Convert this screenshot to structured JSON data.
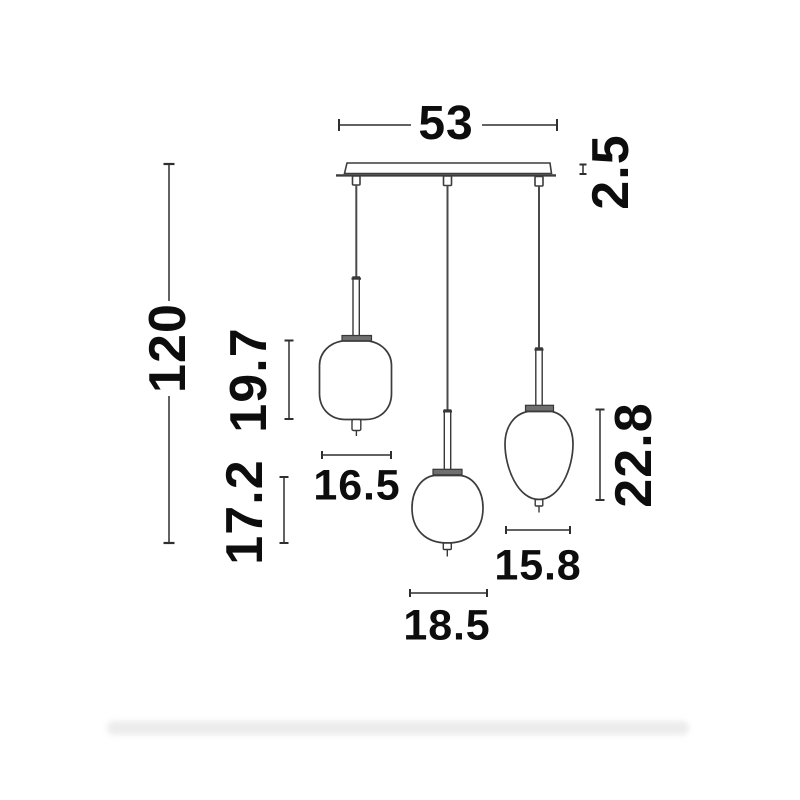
{
  "figure": {
    "kind": "technical dimension drawing",
    "subject": "three-light pendant lamp with linear ceiling canopy and three glass shades"
  },
  "colors": {
    "background": "#ffffff",
    "line": "#3c3c3c",
    "dim_line": "#2f2f2f",
    "text": "#0d0d0d",
    "cap_fill": "#6f6f6f",
    "shadow": "#ececec"
  },
  "dims": {
    "canopy_width": {
      "label": "53",
      "orientation": "horizontal"
    },
    "canopy_thickness": {
      "label": "2.5",
      "orientation": "vertical"
    },
    "total_height": {
      "label": "120",
      "orientation": "vertical"
    },
    "shade_left_height": {
      "label": "19.7",
      "orientation": "vertical"
    },
    "shade_left_width": {
      "label": "16.5",
      "orientation": "horizontal"
    },
    "drop_offset": {
      "label": "17.2",
      "orientation": "vertical"
    },
    "shade_middle_width": {
      "label": "18.5",
      "orientation": "horizontal"
    },
    "shade_right_height": {
      "label": "22.8",
      "orientation": "vertical"
    },
    "shade_right_width": {
      "label": "15.8",
      "orientation": "horizontal"
    }
  }
}
